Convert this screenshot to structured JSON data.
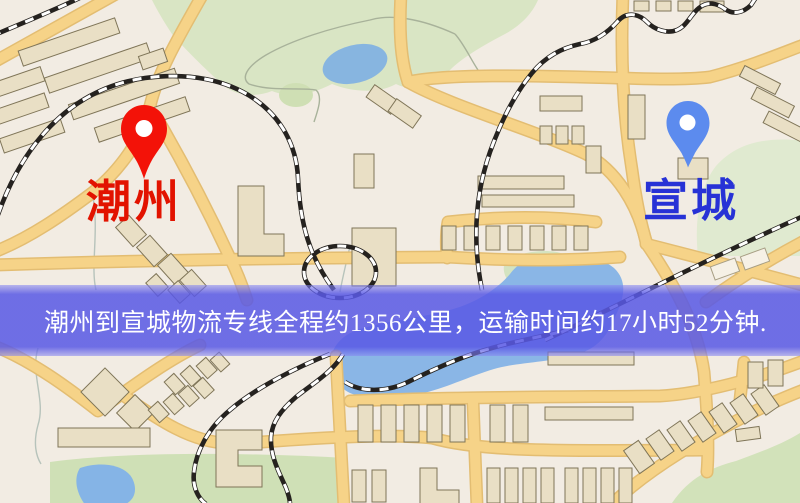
{
  "map": {
    "origin": {
      "label": "潮州"
    },
    "destination": {
      "label": "宣城"
    },
    "banner": {
      "text": "潮州到宣城物流专线全程约1356公里，运输时间约17小时52分钟."
    },
    "colors": {
      "origin_pin": "#f31208",
      "origin_label": "#e21300",
      "destination_pin": "#5c8bee",
      "destination_label": "#2732d6",
      "banner_bg": "#5959e5",
      "banner_text": "#ffffff",
      "road_yellow": "#f6d388",
      "map_background": "#f2ece3",
      "water_blue": "#8ab6e6",
      "park_green": "#d9e5c4"
    }
  }
}
